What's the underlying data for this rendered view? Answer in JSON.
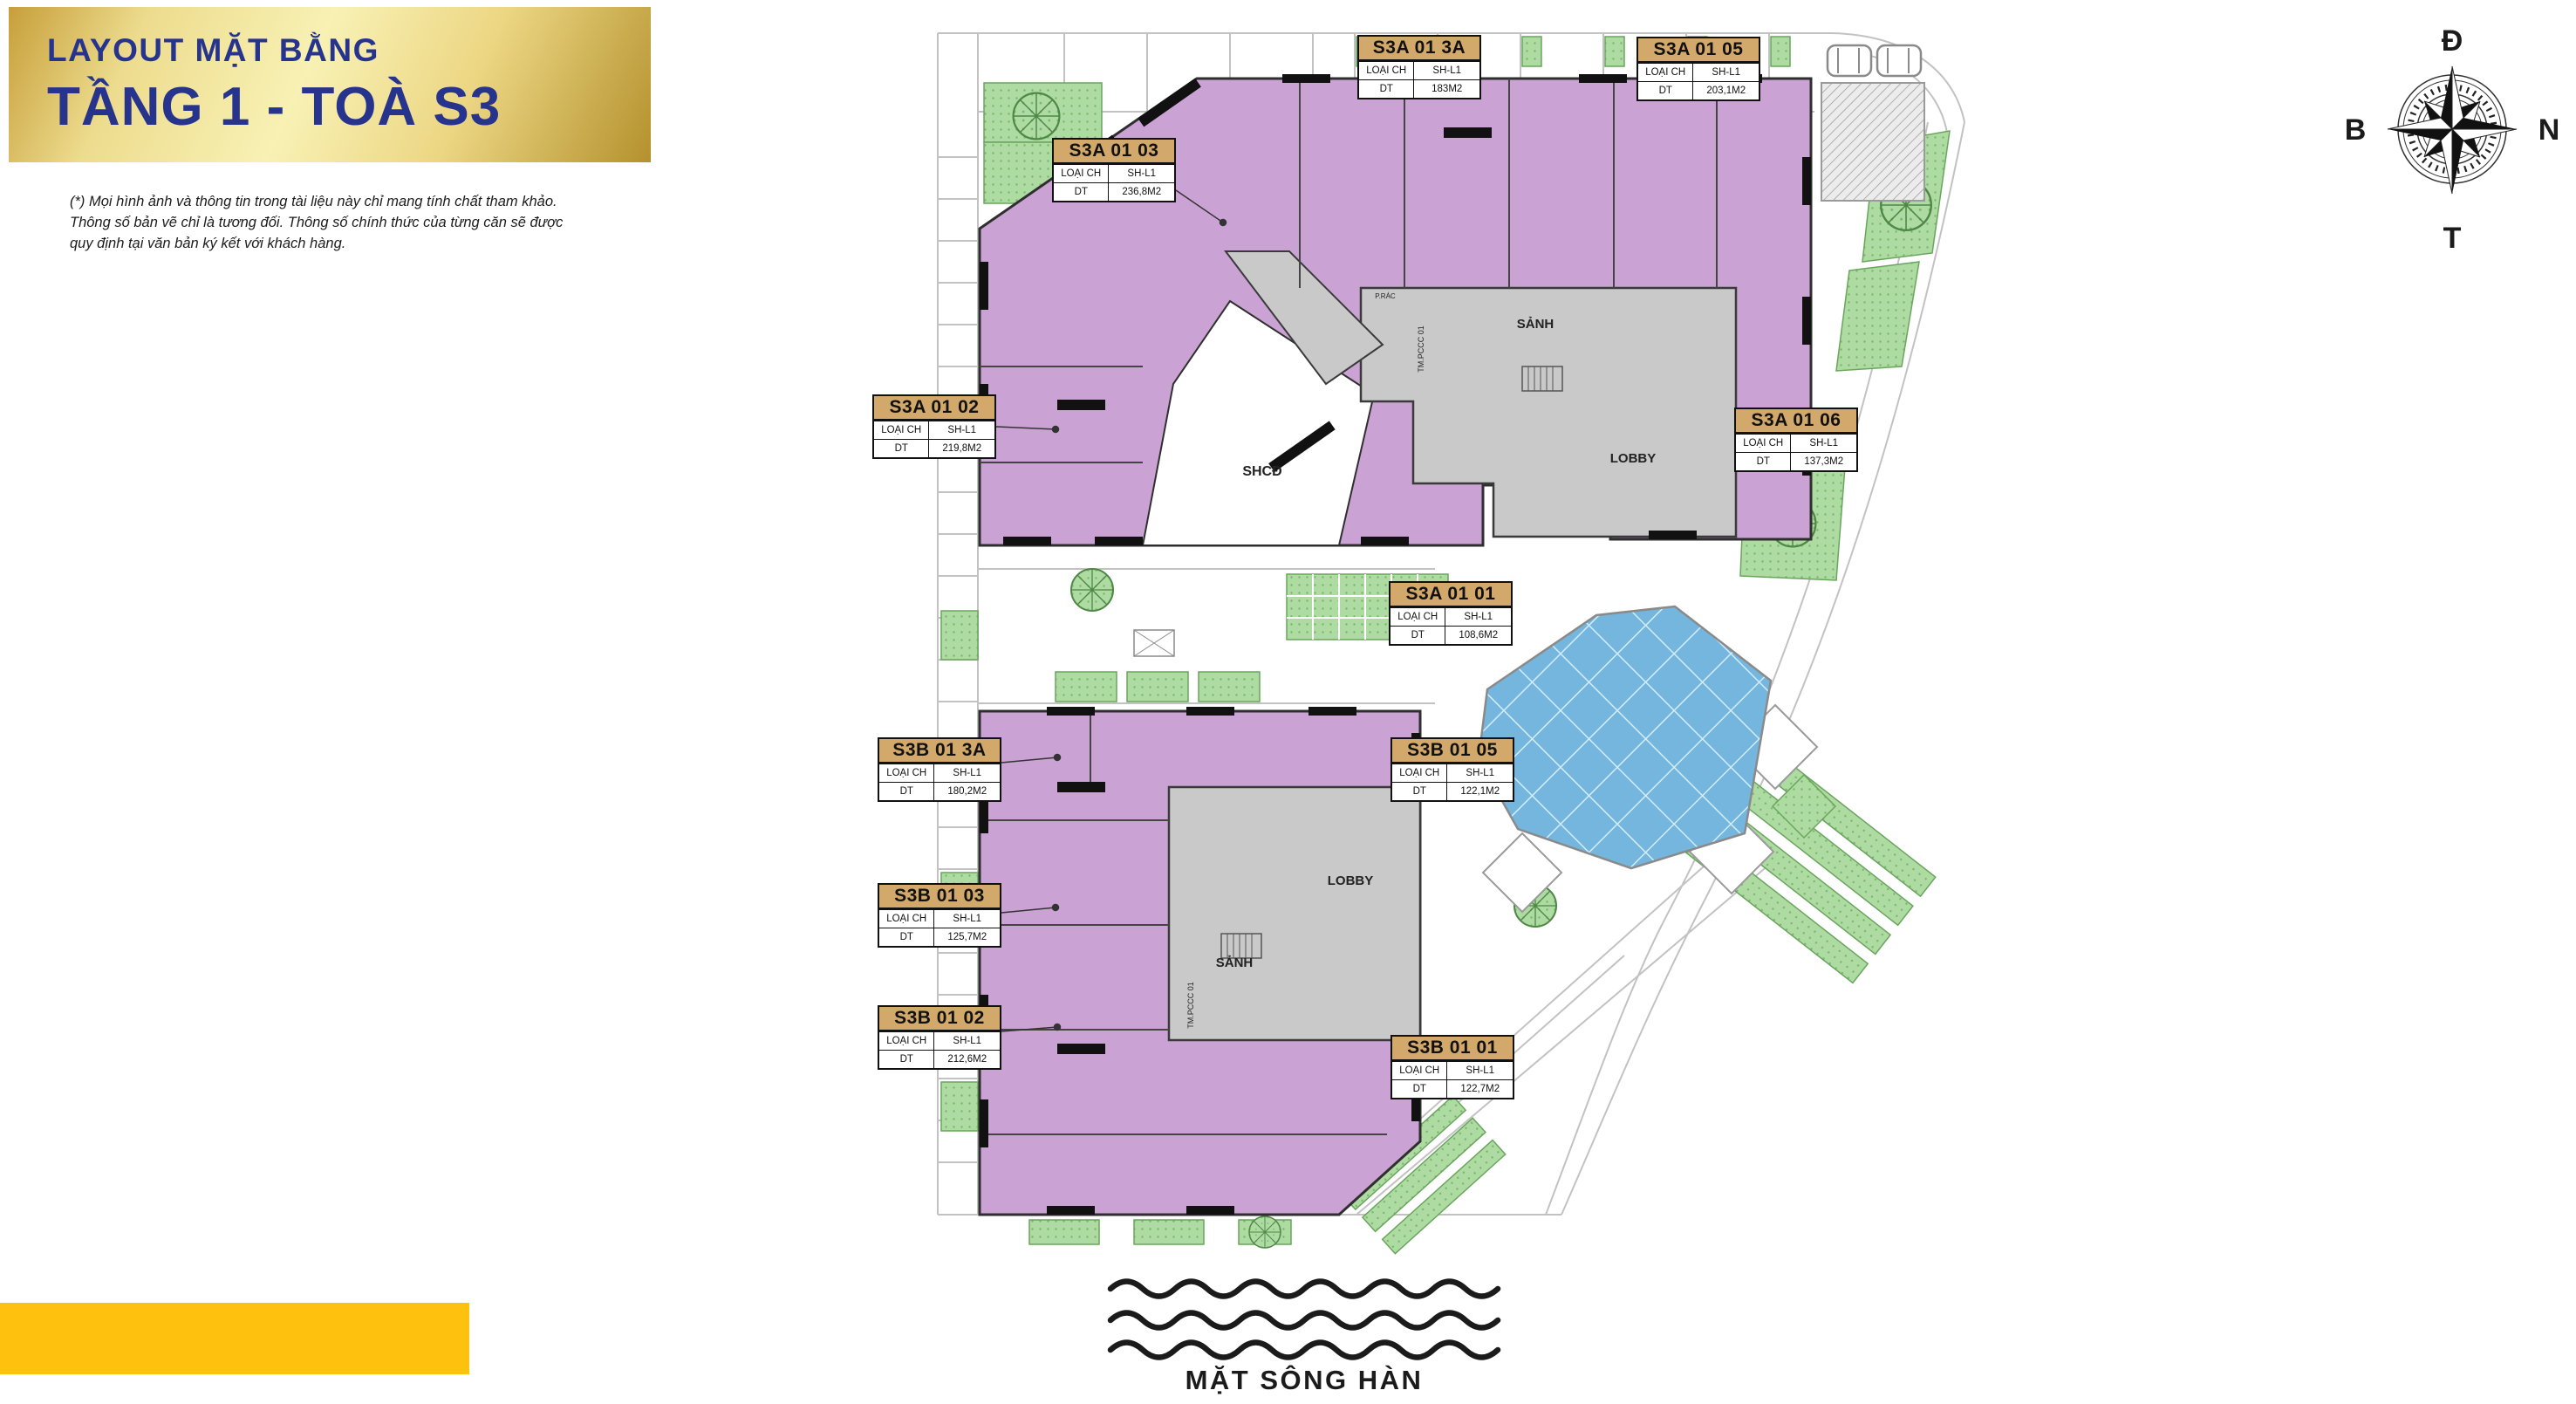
{
  "header": {
    "title_line1": "LAYOUT MẶT BẰNG",
    "title_line2": "TẦNG 1 - TOÀ S3",
    "disclaimer": "(*) Mọi hình ảnh và thông tin trong tài liệu này chỉ mang tính chất tham khảo. Thông số bản vẽ chỉ là tương đối. Thông số chính thức của từng căn sẽ được quy định tại văn bản ký kết với khách hàng."
  },
  "compass": {
    "top": "Đ",
    "right": "N",
    "bottom": "T",
    "left": "B"
  },
  "plan": {
    "card_labels": {
      "type": "LOẠI CH",
      "area": "DT"
    },
    "units": [
      {
        "code": "S3A 01 3A",
        "type": "SH-L1",
        "area": "183M2"
      },
      {
        "code": "S3A 01 05",
        "type": "SH-L1",
        "area": "203,1M2"
      },
      {
        "code": "S3A 01 03",
        "type": "SH-L1",
        "area": "236,8M2"
      },
      {
        "code": "S3A 01 02",
        "type": "SH-L1",
        "area": "219,8M2"
      },
      {
        "code": "S3A 01 06",
        "type": "SH-L1",
        "area": "137,3M2"
      },
      {
        "code": "S3A 01 01",
        "type": "SH-L1",
        "area": "108,6M2"
      },
      {
        "code": "S3B 01 3A",
        "type": "SH-L1",
        "area": "180,2M2"
      },
      {
        "code": "S3B 01 05",
        "type": "SH-L1",
        "area": "122,1M2"
      },
      {
        "code": "S3B 01 03",
        "type": "SH-L1",
        "area": "125,7M2"
      },
      {
        "code": "S3B 01 02",
        "type": "SH-L1",
        "area": "212,6M2"
      },
      {
        "code": "S3B 01 01",
        "type": "SH-L1",
        "area": "122,7M2"
      }
    ],
    "areas": {
      "shcd": "SHCĐ",
      "sanh_a": "SẢNH",
      "lobby_a": "LOBBY",
      "sanh_b": "SẢNH",
      "lobby_b": "LOBBY",
      "pccc_a": "TM.PCCC 01",
      "pccc_b": "TM.PCCC 01",
      "p_rac": "P.RÁC"
    }
  },
  "river": {
    "label": "MẶT SÔNG HÀN"
  },
  "colors": {
    "title_navy": "#27348E",
    "banner_gold": "#E7CF7E",
    "card_header_tan": "#D2A96B",
    "unit_purple": "#CBA2D4",
    "core_gray": "#C9C9C9",
    "green": "#AEDBA2",
    "pool_blue": "#74B6DD",
    "bottom_bar_yellow": "#FEC20E"
  }
}
